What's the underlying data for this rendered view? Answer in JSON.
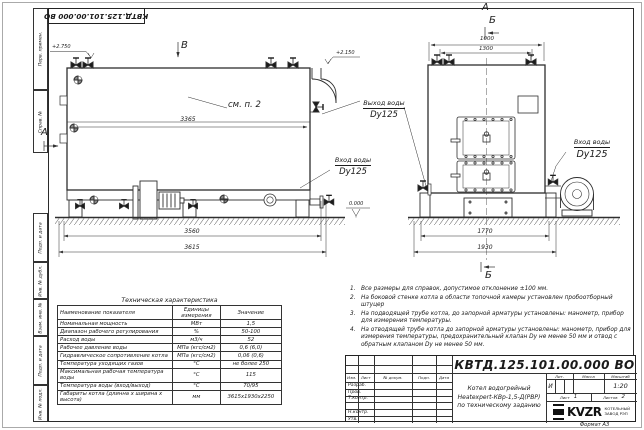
{
  "doc_number": "КВТД.125.101.00.000 ВО",
  "format_label": "Формат А3",
  "margin": {
    "labels": [
      "Перв. примен.",
      "Справ. №",
      "Подп. и дата",
      "Инв. № дубл.",
      "Взам. инв. №",
      "Подп. и дата",
      "Инв. № подл."
    ]
  },
  "drawing": {
    "view_b": "В",
    "view_a_left": "А",
    "view_a_top": "А",
    "view_b_top": "Б",
    "view_b_bottom": "Б",
    "elev_left": "+2.750",
    "elev_right": "+2.150",
    "level_zero": "0.000",
    "note_ref": "см. п. 2",
    "dim_3365": "3365",
    "dim_3560": "3560",
    "dim_3615": "3615",
    "dim_1000": "1000",
    "dim_1300": "1300",
    "dim_1770": "1770",
    "dim_1930": "1930",
    "outlet_label": "Выход воды",
    "outlet_dn": "Dy125",
    "inlet_left_label": "Вход воды",
    "inlet_left_dn": "Dy125",
    "inlet_right_label": "Вход воды",
    "inlet_right_dn": "Dy125"
  },
  "notes": {
    "items": [
      {
        "n": "1.",
        "t": "Все размеры для справок, допустимое отклонение ±100 мм."
      },
      {
        "n": "2.",
        "t": "На боковой стенке котла в области топочной камеры установлен пробоотборный штуцер"
      },
      {
        "n": "3.",
        "t": "На подводящей трубе котла, до запорной арматуры установлены: манометр, прибор для измерения температуры."
      },
      {
        "n": "4.",
        "t": "На отводящей трубе котла до запорной арматуры установлены: манометр, прибор для измерения температуры, предохранительный клапан Dу не менее 50 мм и отвод с обратным клапаном Dу не менее 50 мм."
      }
    ]
  },
  "spec": {
    "title": "Техническая характеристика",
    "headers": [
      "Наименование показателя",
      "Единицы измерения",
      "Значение"
    ],
    "rows": [
      [
        "Номинальная мощность",
        "МВт",
        "1,5"
      ],
      [
        "Диапазон рабочего регулирования",
        "%",
        "50-100"
      ],
      [
        "Расход воды",
        "м3/ч",
        "52"
      ],
      [
        "Рабочее давление воды",
        "МПа (кгс/см2)",
        "0,6 (6,0)"
      ],
      [
        "Гидравлическое сопротивление котла",
        "МПа (кгс/см2)",
        "0,06 (0,6)"
      ],
      [
        "Температура уходящих газов",
        "°С",
        "не более 250"
      ],
      [
        "Максимальная рабочая температура воды",
        "°С",
        "115"
      ],
      [
        "Температура воды (вход/выход)",
        "°С",
        "70/95"
      ],
      [
        "Габариты котла (длинна х ширина х высота)",
        "мм",
        "3615х1930х2250"
      ]
    ]
  },
  "titleblock": {
    "columns": [
      "Изм.",
      "Лист",
      "№ докум.",
      "Подп.",
      "Дата"
    ],
    "roles": [
      "Разраб.",
      "Пров.",
      "Т.контр.",
      "",
      "Н.контр.",
      "Утв."
    ],
    "product_line1": "Котел водогрейный",
    "product_line2": "Heatexpert-КВр-1,5-Д(РВР)",
    "product_line3": "по техническому заданию",
    "lit_label": "Лит.",
    "lit_value": "И",
    "mass_label": "Масса",
    "scale_label": "Масштаб",
    "scale_value": "1:20",
    "sheet_label": "Лист",
    "sheet_number": "1",
    "sheets_label": "Листов",
    "sheets_total": "2",
    "logo_text": "KVZR",
    "factory_line1": "КОТЕЛЬНЫЙ",
    "factory_line2": "ЗАВОД РЭП"
  }
}
